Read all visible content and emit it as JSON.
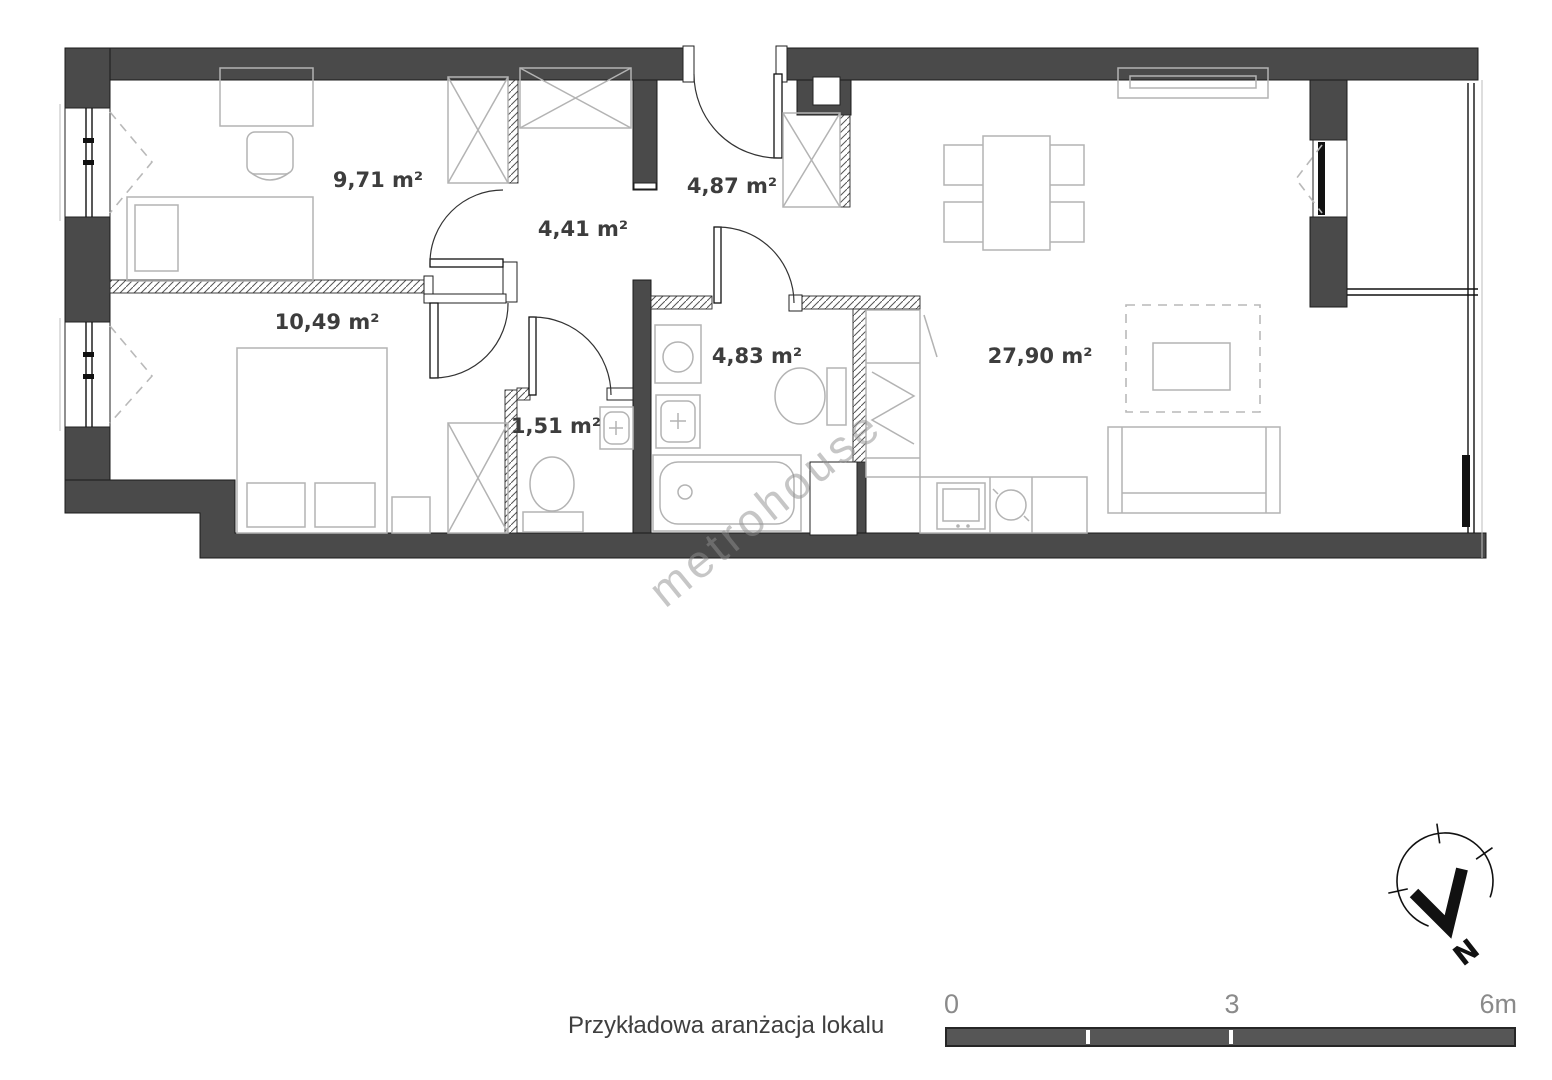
{
  "plan": {
    "watermark": "metrohouse",
    "caption": "Przykładowa aranżacja lokalu",
    "rooms": [
      {
        "id": "office",
        "area_label": "9,71 m²"
      },
      {
        "id": "entry",
        "area_label": "4,87 m²"
      },
      {
        "id": "hall",
        "area_label": "4,41 m²"
      },
      {
        "id": "bedroom",
        "area_label": "10,49 m²"
      },
      {
        "id": "wc",
        "area_label": "1,51 m²"
      },
      {
        "id": "bathroom",
        "area_label": "4,83 m²"
      },
      {
        "id": "living",
        "area_label": "27,90 m²"
      }
    ],
    "scale_bar": {
      "start_label": "0",
      "mid_label": "3",
      "end_label": "6m"
    },
    "compass": {
      "north_label": "N"
    },
    "colors": {
      "wall": "#4a4a4a",
      "furniture_outline": "#b3b3b3",
      "room_label": "#3d3d3d",
      "scale_text": "#8a8a8a",
      "scale_bar_fill": "#565656",
      "watermark": "#8f8f8f"
    }
  }
}
